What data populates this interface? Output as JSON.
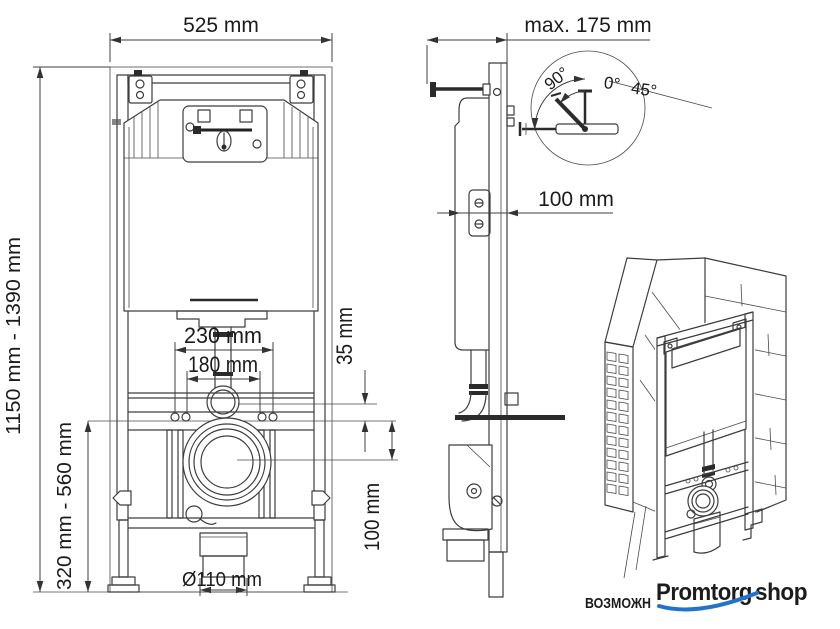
{
  "front": {
    "width": "525 mm",
    "height_range": "1150 mm - 1390 mm",
    "leg_range": "320 mm - 560 mm",
    "inlet_spacing": "230 mm",
    "fix_spacing": "180 mm",
    "flush_offset": "35 mm",
    "drain_offset": "100 mm",
    "drain_dia": "Ø110 mm"
  },
  "side": {
    "max_depth": "max. 175 mm",
    "depth": "100 mm"
  },
  "detail": {
    "a90": "90°",
    "a0": "0°",
    "a45": "45°"
  },
  "footer": {
    "note": "ВОЗМОЖН",
    "brand1": "Promtorg",
    "brand2": "shop",
    "blue": "#2273c9",
    "dark": "#1d1d1f"
  },
  "colors": {
    "line": "#3d3d3d"
  }
}
